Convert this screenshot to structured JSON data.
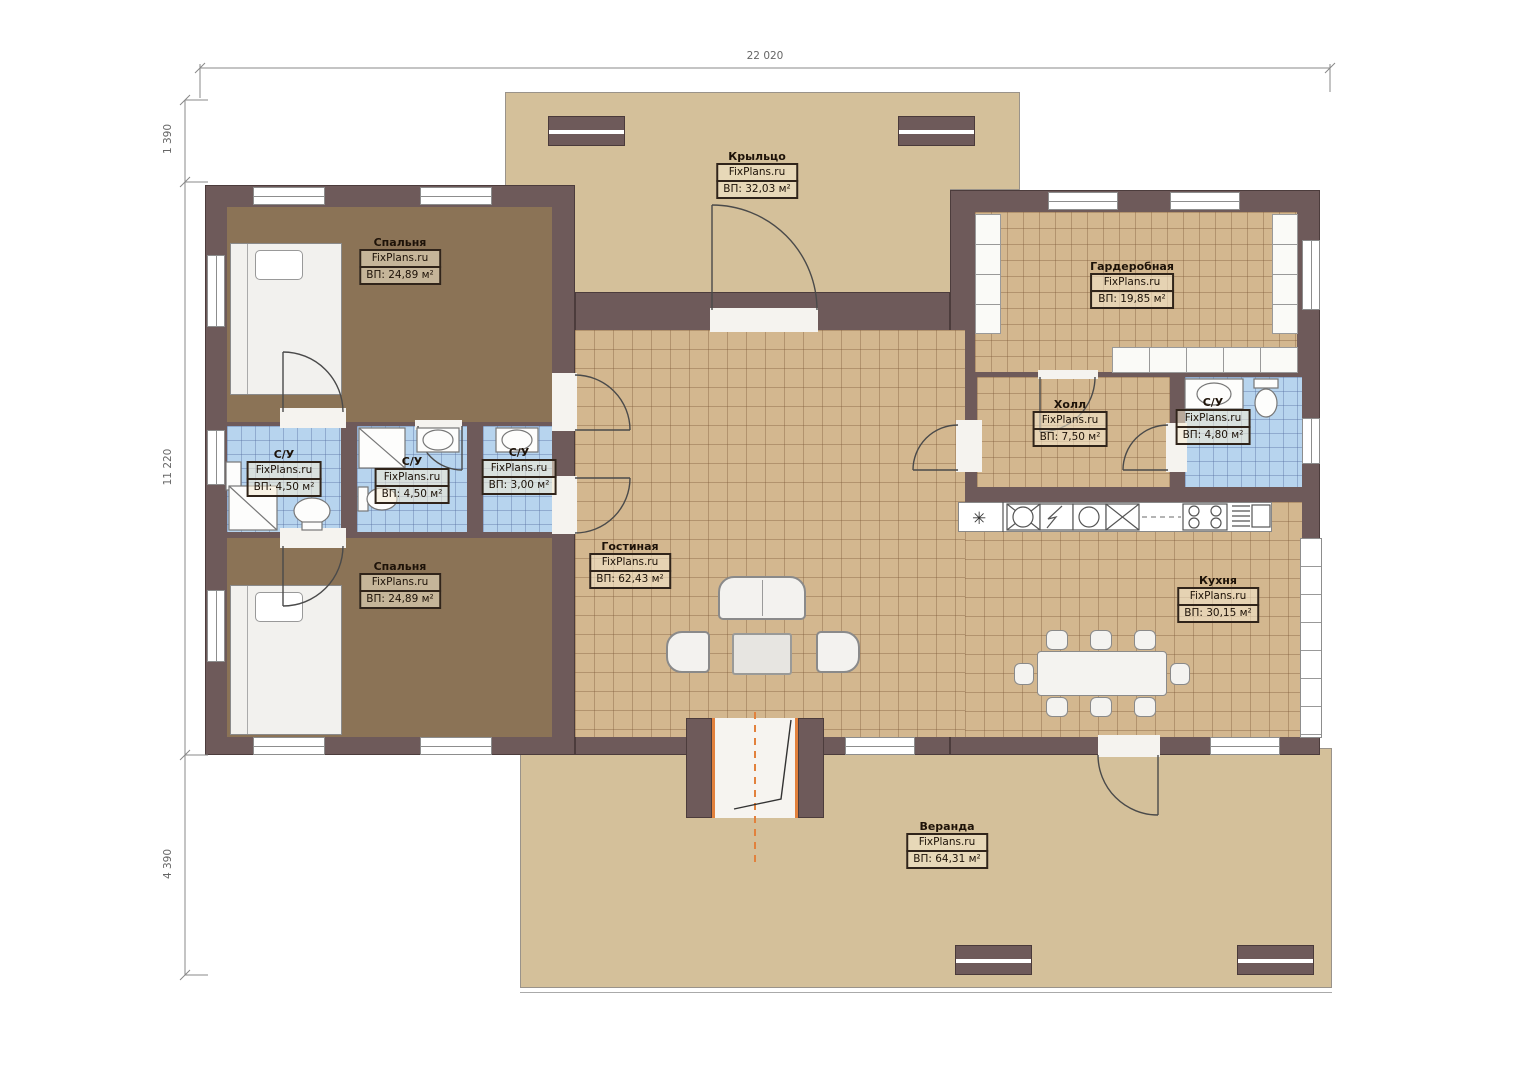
{
  "brand": "FixPlans.ru",
  "dimensions": {
    "width_top": "22 020",
    "left_top": "1 390",
    "left_middle": "11 220",
    "left_bottom": "4 390"
  },
  "rooms": {
    "porch": {
      "name": "Крыльцо",
      "brand": "FixPlans.ru",
      "area": "ВП: 32,03 м²"
    },
    "bedroom1": {
      "name": "Спальня",
      "brand": "FixPlans.ru",
      "area": "ВП: 24,89 м²"
    },
    "bedroom2": {
      "name": "Спальня",
      "brand": "FixPlans.ru",
      "area": "ВП: 24,89 м²"
    },
    "wc1": {
      "name": "С/У",
      "brand": "FixPlans.ru",
      "area": "ВП: 4,50 м²"
    },
    "wc2": {
      "name": "С/У",
      "brand": "FixPlans.ru",
      "area": "ВП: 4,50 м²"
    },
    "wc3": {
      "name": "С/У",
      "brand": "FixPlans.ru",
      "area": "ВП: 3,00 м²"
    },
    "wardrobe": {
      "name": "Гардеробная",
      "brand": "FixPlans.ru",
      "area": "ВП: 19,85 м²"
    },
    "hall": {
      "name": "Холл",
      "brand": "FixPlans.ru",
      "area": "ВП: 7,50 м²"
    },
    "wc4": {
      "name": "С/У",
      "brand": "FixPlans.ru",
      "area": "ВП: 4,80 м²"
    },
    "living": {
      "name": "Гостиная",
      "brand": "FixPlans.ru",
      "area": "ВП: 62,43 м²"
    },
    "kitchen": {
      "name": "Кухня",
      "brand": "FixPlans.ru",
      "area": "ВП: 30,15 м²"
    },
    "veranda": {
      "name": "Веранда",
      "brand": "FixPlans.ru",
      "area": "ВП: 64,31 м²"
    }
  },
  "icons": {
    "snowflake": "✳"
  },
  "colors": {
    "wall": "#6e5a5a",
    "tile_floor": "#d3b78f",
    "bathroom_floor": "#b7d4ee",
    "bedroom_floor": "#8b7356",
    "deck_floor": "#d4c09a",
    "accent_orange": "#e2813c"
  }
}
